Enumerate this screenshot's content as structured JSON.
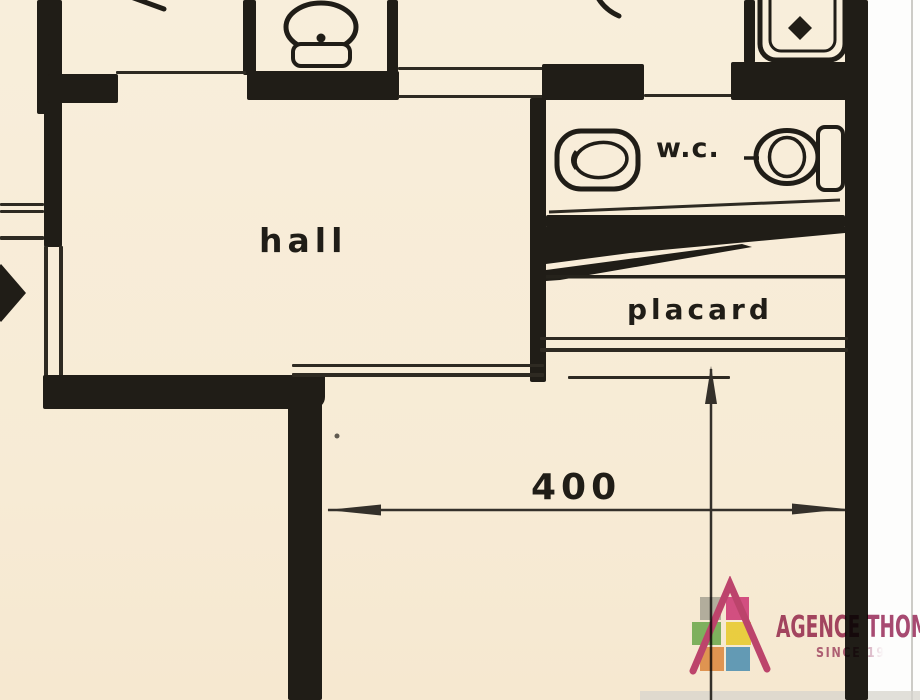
{
  "document": {
    "kind": "scanned apartment floor plan (partial view)"
  },
  "rooms": {
    "hall": {
      "label": "hall"
    },
    "wc": {
      "label": "w.c."
    },
    "placard": {
      "label": "placard"
    }
  },
  "dimension": {
    "value": "400"
  },
  "fixtures": [
    "toilet-with-cistern",
    "shower-tray",
    "bidet",
    "wc-toilet",
    "wall-cistern"
  ],
  "markers": [
    "door-swing-tip",
    "door-swing-tip",
    "direction-diamond",
    "hatched-sloped-band"
  ],
  "dimension_lines": [
    {
      "orientation": "horizontal",
      "label": "400"
    },
    {
      "orientation": "vertical",
      "label": ""
    }
  ],
  "colors": {
    "paper": "#f8eedb",
    "ink": "#201d17",
    "page_white": "#fdfdfc",
    "logo_roof_pink": "#c34a82",
    "logo_text": "#a84a72",
    "logo_gray": "#b9bdbe",
    "logo_pink": "#d9569b",
    "logo_green": "#83c171",
    "logo_yellow": "#f2e14e",
    "logo_orange": "#e8a263",
    "logo_blue": "#66a9dc"
  },
  "logo": {
    "brand": "AGENCE THOMAS",
    "tagline": "SINCE 19"
  }
}
